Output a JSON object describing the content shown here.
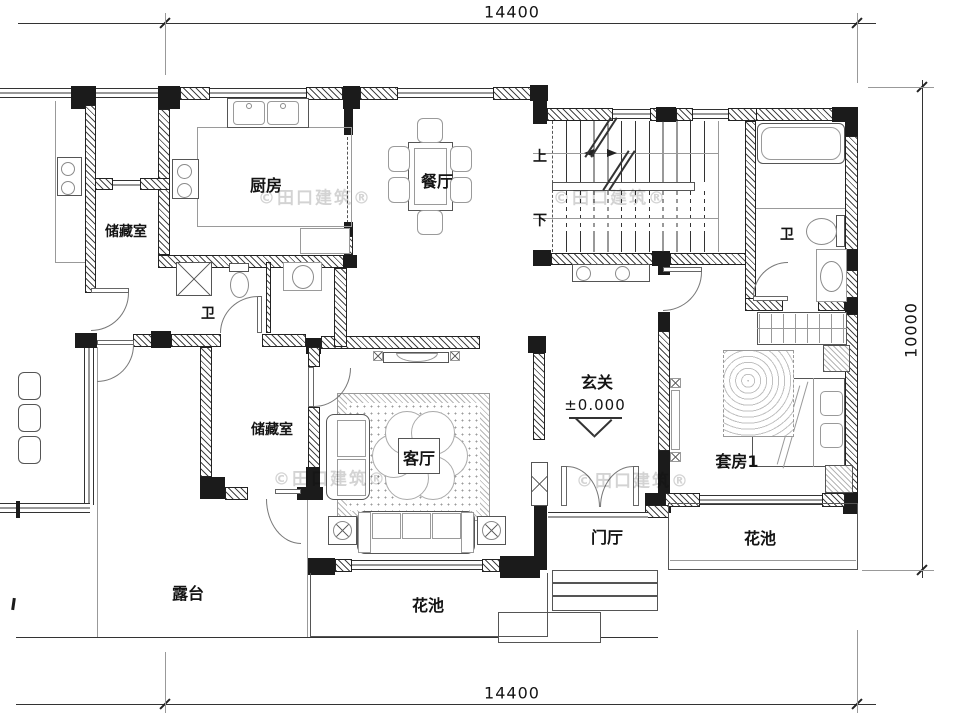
{
  "watermark": {
    "text": "©田口建筑®"
  },
  "dimensions": {
    "width_top": "14400",
    "width_bottom": "14400",
    "depth_right": "10000"
  },
  "rooms": {
    "kitchen": "厨房",
    "dining": "餐厅",
    "storage_top": "储藏室",
    "bath_small": "卫",
    "bath_suite": "卫",
    "stair_up": "上",
    "stair_down": "下",
    "foyer": "玄关",
    "foyer_level": "±0.000",
    "living": "客厅",
    "storage_lower": "储藏室",
    "suite": "套房1",
    "porch": "门厅",
    "terrace": "露台",
    "flower_right": "花池",
    "flower_bottom": "花池"
  }
}
